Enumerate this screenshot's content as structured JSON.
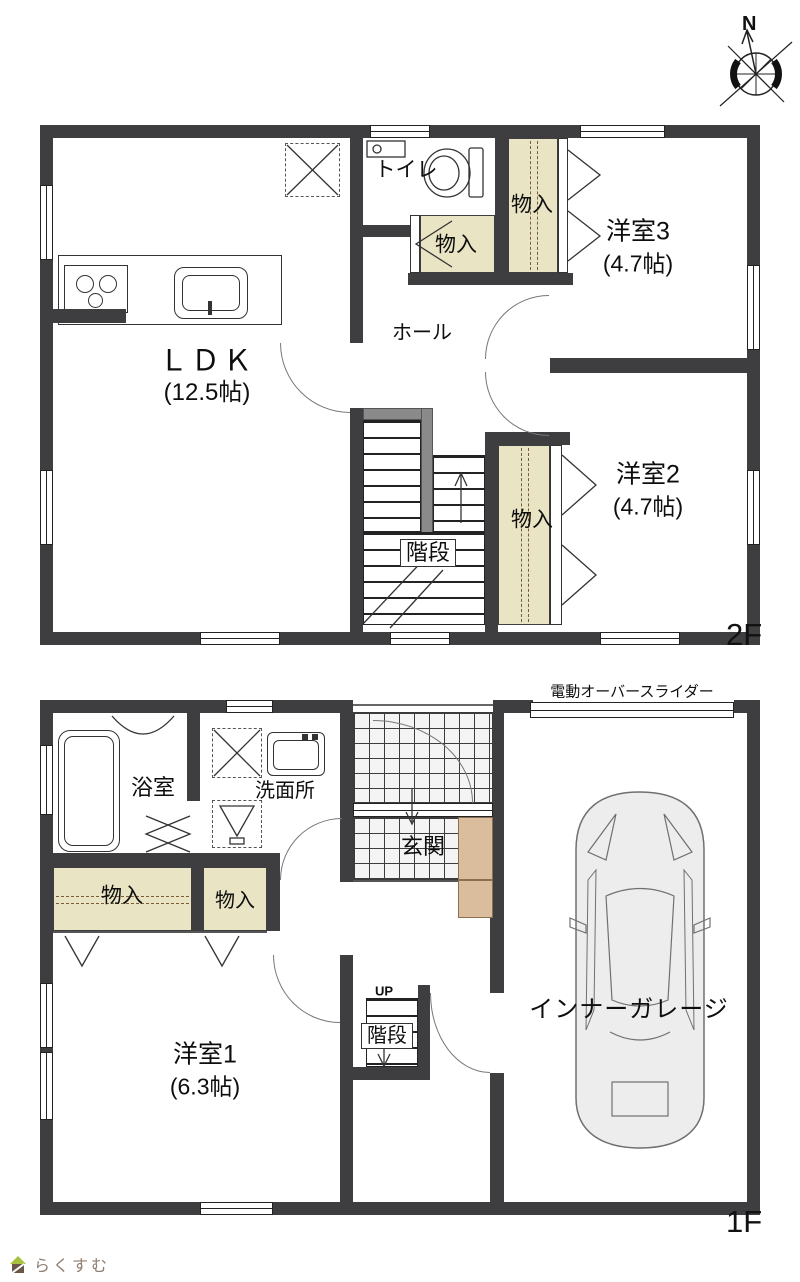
{
  "compass": {
    "label": "N"
  },
  "floor2": {
    "floor_label": "2F",
    "rooms": {
      "ldk_name": "ＬＤＫ",
      "ldk_size": "(12.5帖)",
      "toilet": "トイレ",
      "closet_center": "物入",
      "closet_top": "物入",
      "closet_bottom": "物入",
      "room3_name": "洋室3",
      "room3_size": "(4.7帖)",
      "room2_name": "洋室2",
      "room2_size": "(4.7帖)",
      "hall": "ホール",
      "stairs": "階段"
    }
  },
  "floor1": {
    "floor_label": "1F",
    "garage_shutter_label": "電動オーバースライダー",
    "rooms": {
      "bath": "浴室",
      "washroom": "洗面所",
      "entrance": "玄関",
      "closet_left": "物入",
      "closet_right": "物入",
      "room1_name": "洋室1",
      "room1_size": "(6.3帖)",
      "stairs": "階段",
      "stairs_up": "UP",
      "garage": "インナーガレージ"
    }
  },
  "logo": {
    "text": "らくすむ"
  },
  "colors": {
    "wall": "#3e3e40",
    "closet_fill": "#e9e4c3",
    "cabinet_fill": "#d9bd9c",
    "stair_rail": "#8a8a8a",
    "logo_text": "#8f7e71",
    "logo_roof": "#a8c13f",
    "logo_body": "#6b5647"
  }
}
